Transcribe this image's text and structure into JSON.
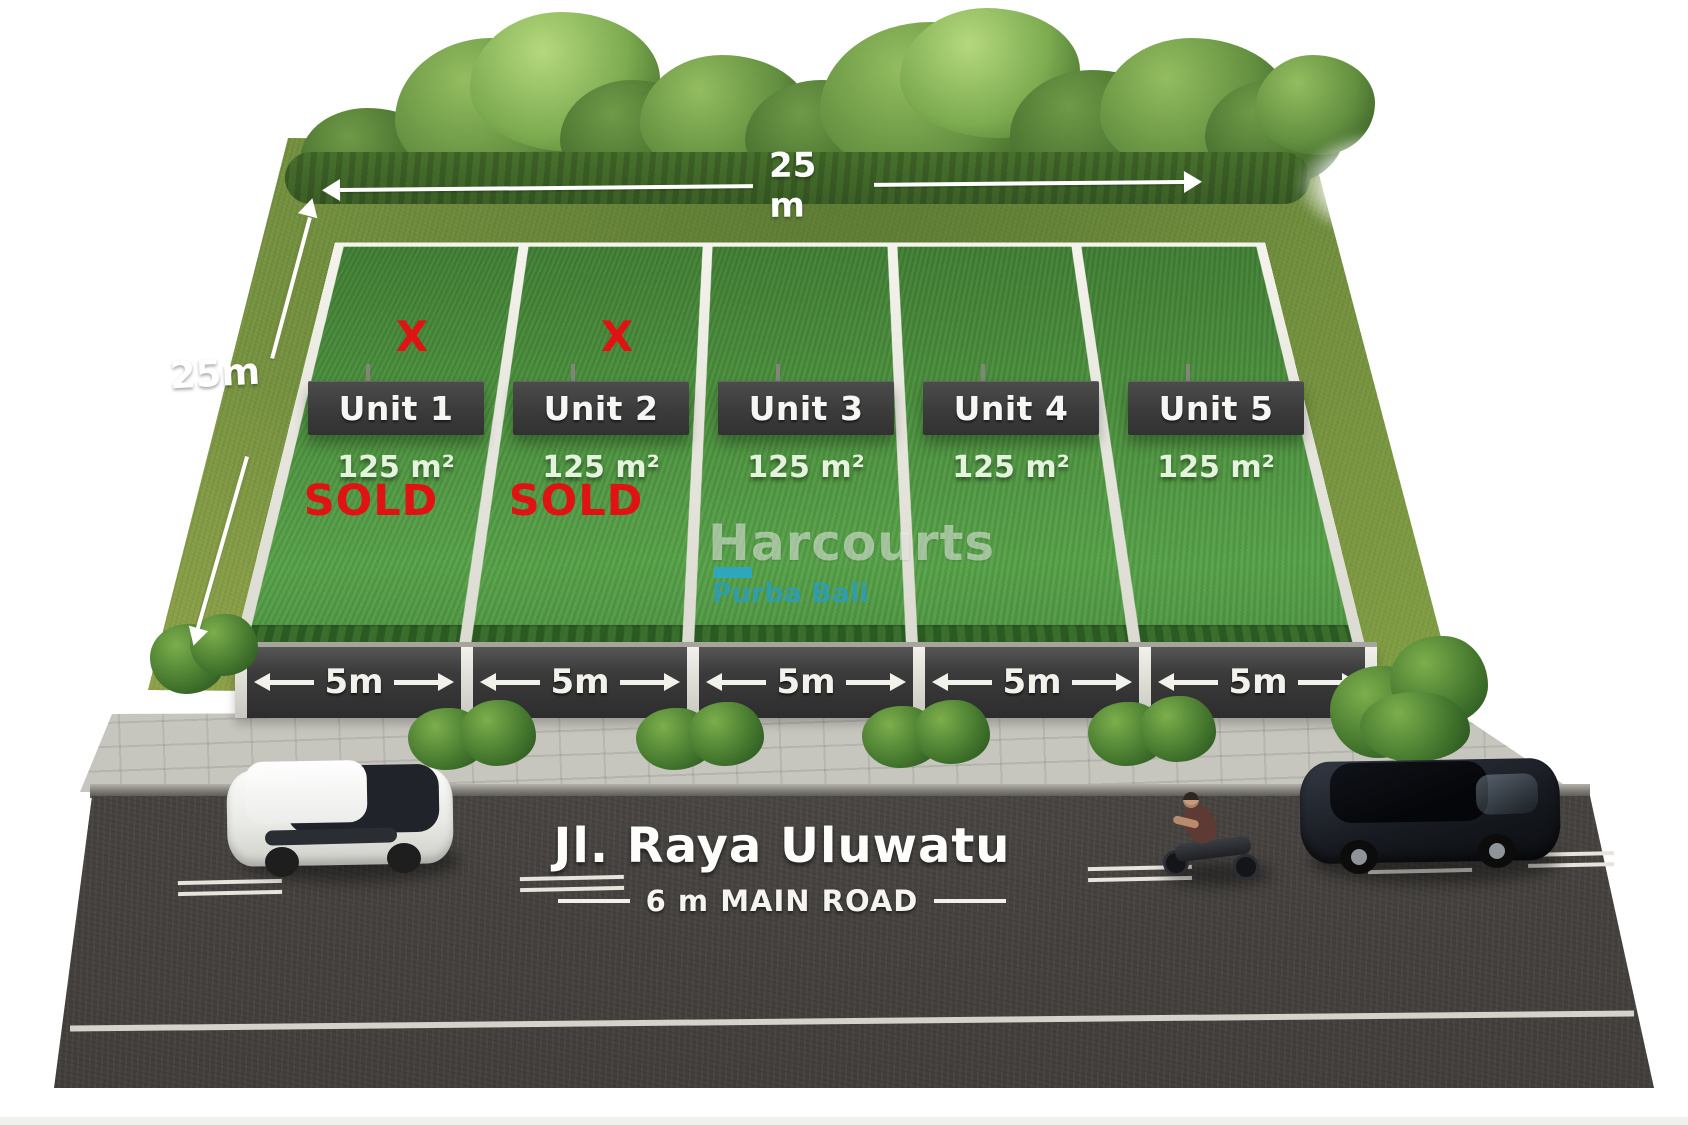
{
  "site": {
    "width_label": "25 m",
    "depth_label": "25m"
  },
  "units": [
    {
      "name": "Unit 1",
      "area": "125 m²",
      "frontage": "5m",
      "status": "SOLD",
      "mark": "X"
    },
    {
      "name": "Unit 2",
      "area": "125 m²",
      "frontage": "5m",
      "status": "SOLD",
      "mark": "X"
    },
    {
      "name": "Unit 3",
      "area": "125 m²",
      "frontage": "5m",
      "status": "",
      "mark": ""
    },
    {
      "name": "Unit 4",
      "area": "125 m²",
      "frontage": "5m",
      "status": "",
      "mark": ""
    },
    {
      "name": "Unit 5",
      "area": "125 m²",
      "frontage": "5m",
      "status": "",
      "mark": ""
    }
  ],
  "road": {
    "name": "Jl. Raya Uluwatu",
    "spec": "6 m MAIN ROAD"
  },
  "watermark": {
    "brand": "Harcourts",
    "office": "Purba Bali"
  },
  "colors": {
    "accent_cyan": "#2ba7c5",
    "sold_red": "#e01212",
    "plot_green": "#4a8f3c",
    "sign_gray": "#3f3f3f",
    "road_gray": "#4b4845"
  }
}
